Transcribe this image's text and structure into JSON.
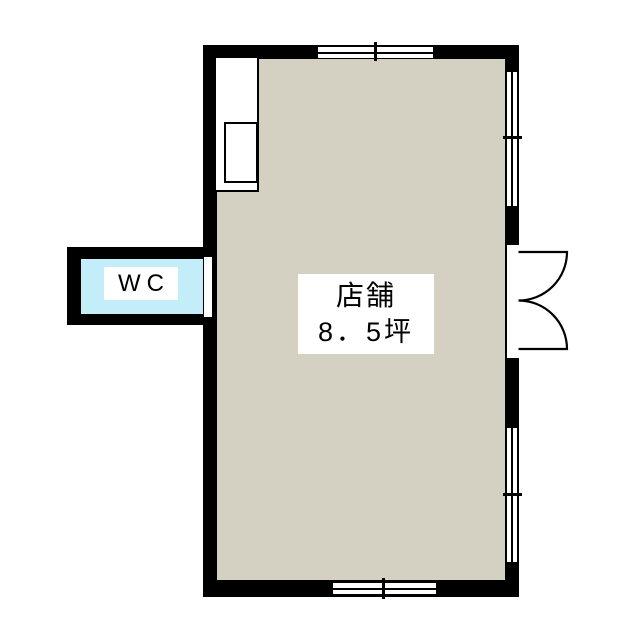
{
  "shop": {
    "name": "店舗",
    "area": "8．5坪"
  },
  "wc": {
    "label": "WC"
  },
  "colors": {
    "wall": "#000000",
    "shop_floor": "#d4d1c3",
    "wc_floor": "#c3edf8",
    "background": "#ffffff"
  },
  "symbols": {
    "entrance": "double-swing-door-icon",
    "openings": "sliding-window-icon",
    "fixture": "counter-with-sink-icon"
  }
}
